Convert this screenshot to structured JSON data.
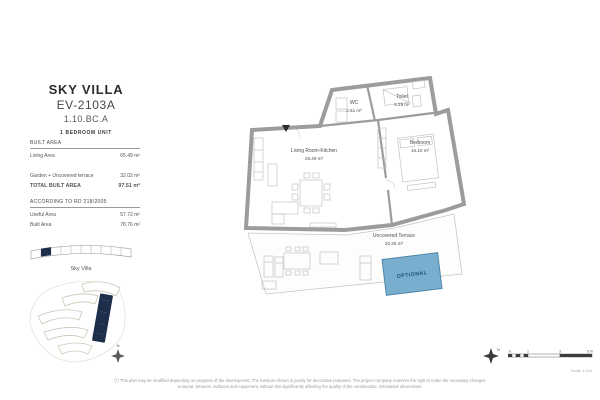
{
  "title_block": {
    "project": "SKY VILLA",
    "unit_code": "EV-2103A",
    "unit_ref": "1.10.BC.A",
    "unit_type": "1 BEDROOM UNIT"
  },
  "areas": {
    "built_heading": "BUILT AREA",
    "rows": [
      {
        "label": "Living Area",
        "value": "65.49 m²"
      },
      {
        "label": "Garden + Uncovered terrace",
        "value": "32.02 m²"
      }
    ],
    "total_label": "TOTAL BUILT AREA",
    "total_value": "97.51 m²",
    "rd_heading": "ACCORDING TO RD 218/2005",
    "rd_rows": [
      {
        "label": "Useful Area",
        "value": "57.72 m²"
      },
      {
        "label": "Built Area",
        "value": "78.76 m²"
      }
    ]
  },
  "key": {
    "elevation_caption": "Sky Villa",
    "north_label": "N"
  },
  "floor_plan": {
    "rooms": [
      {
        "name": "Living Room-Kitchen",
        "area": "28.49 m²"
      },
      {
        "name": "Bedroom",
        "area": "16.10 m²"
      },
      {
        "name": "WC",
        "area": "2.61 m²"
      },
      {
        "name": "Toilet",
        "area": "5.29 m²"
      },
      {
        "name": "Uncovered Terrace",
        "area": "32.25 m²"
      }
    ],
    "pool_label": "OPTIONAL",
    "colors": {
      "wall": "#9c9c9c",
      "pool_fill": "#79aecf",
      "pool_border": "#4e86a8",
      "highlight_navy": "#1e2d4a"
    }
  },
  "scale": {
    "ticks": [
      "0",
      "1",
      "3",
      "5 m"
    ],
    "caption": "Scale 1:100",
    "north_label": "N"
  },
  "disclaimer": {
    "line1": "(*) This plan may be modified depending on progress of the development. The furniture shown is purely for decorative purposes. The project company reserves the right to make the necessary changes",
    "line2": "to layout, terraces, surfaces and equipment, without this significantly affecting the quality of the construction. Orientative dimensions."
  }
}
